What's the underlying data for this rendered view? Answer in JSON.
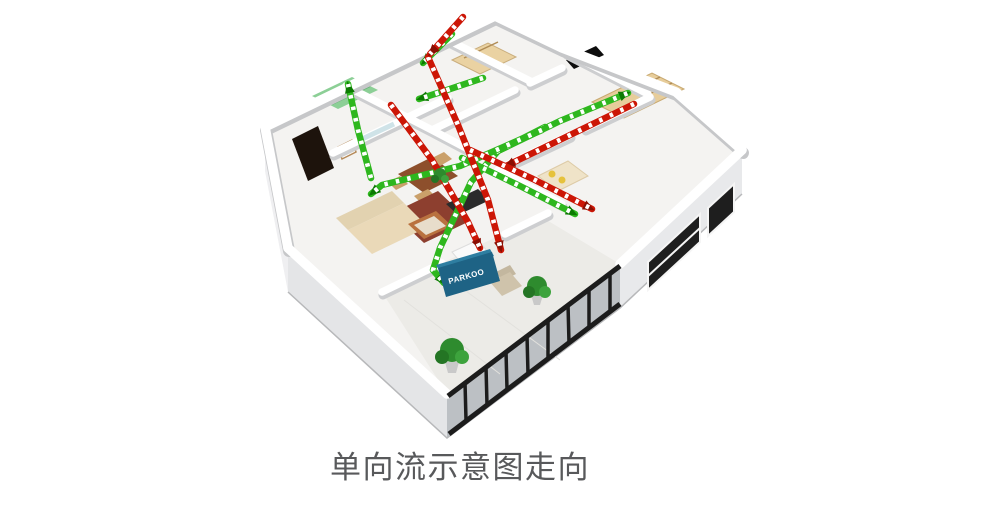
{
  "caption": {
    "text": "单向流示意图走向"
  },
  "unit": {
    "brand": "PARKOO"
  },
  "diagram": {
    "colors": {
      "supply_green": "#2eb71e",
      "exhaust_red": "#cc1606",
      "supply_arrow_dark": "#0c7a02",
      "exhaust_arrow_dark": "#8a0e03",
      "unit_blue": "#1e6385",
      "unit_blue_top": "#2e7ea1"
    },
    "flow_paths": [
      {
        "name": "supply-unit-riser",
        "type": "supply",
        "points": [
          [
            545,
            127
          ],
          [
            498,
            151
          ],
          [
            471,
            182
          ],
          [
            440,
            248
          ],
          [
            433,
            270
          ],
          [
            444,
            283
          ]
        ]
      },
      {
        "name": "supply-right-bedroom",
        "type": "supply",
        "points": [
          [
            496,
            152
          ],
          [
            560,
            121
          ],
          [
            628,
            93
          ]
        ]
      },
      {
        "name": "supply-dining",
        "type": "supply",
        "points": [
          [
            542,
            130
          ],
          [
            460,
            166
          ],
          [
            382,
            185
          ],
          [
            371,
            194
          ]
        ]
      },
      {
        "name": "supply-kitchen",
        "type": "supply",
        "points": [
          [
            483,
            78
          ],
          [
            444,
            91
          ],
          [
            419,
            99
          ]
        ]
      },
      {
        "name": "supply-left-riser",
        "type": "supply",
        "points": [
          [
            371,
            178
          ],
          [
            358,
            130
          ],
          [
            348,
            84
          ]
        ]
      },
      {
        "name": "supply-bedroom2",
        "type": "supply",
        "points": [
          [
            462,
            158
          ],
          [
            520,
            186
          ],
          [
            575,
            214
          ]
        ]
      },
      {
        "name": "supply-top",
        "type": "supply",
        "points": [
          [
            452,
            34
          ],
          [
            423,
            63
          ]
        ]
      },
      {
        "name": "exhaust-trunk",
        "type": "exhaust",
        "points": [
          [
            428,
            57
          ],
          [
            458,
            125
          ],
          [
            488,
            200
          ],
          [
            501,
            250
          ]
        ]
      },
      {
        "name": "exhaust-dining-cross",
        "type": "exhaust",
        "points": [
          [
            391,
            105
          ],
          [
            432,
            160
          ],
          [
            468,
            222
          ],
          [
            480,
            248
          ]
        ]
      },
      {
        "name": "exhaust-right-bedroom",
        "type": "exhaust",
        "points": [
          [
            634,
            104
          ],
          [
            568,
            136
          ],
          [
            506,
            166
          ]
        ]
      },
      {
        "name": "exhaust-top",
        "type": "exhaust",
        "points": [
          [
            463,
            17
          ],
          [
            430,
            54
          ]
        ]
      },
      {
        "name": "exhaust-bedroom2",
        "type": "exhaust",
        "points": [
          [
            470,
            150
          ],
          [
            533,
            179
          ],
          [
            592,
            209
          ]
        ]
      }
    ]
  }
}
